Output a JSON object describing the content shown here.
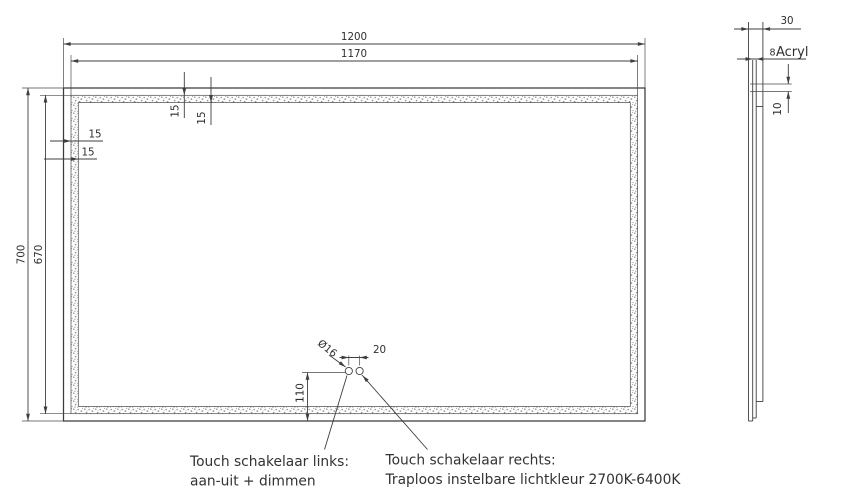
{
  "colors": {
    "line": "#3f3f3f",
    "text": "#2f2f2f",
    "background": "#ffffff"
  },
  "front_view": {
    "dim_width_outer": "1200",
    "dim_width_inner": "1170",
    "dim_height_outer": "700",
    "dim_height_inner": "670",
    "dim_border_top_offset": "15",
    "dim_border_top_width": "15",
    "dim_border_left_offset": "15",
    "dim_border_left_width": "15",
    "switch_diameter": "Ø16",
    "switch_spacing": "20",
    "switch_height": "110"
  },
  "side_view": {
    "dim_depth": "30",
    "acryl_thickness": "8",
    "acryl_label": "Acryl",
    "dim_led_offset": "10"
  },
  "annotations": {
    "switch_left_title": "Touch schakelaar links:",
    "switch_left_desc": "aan-uit + dimmen",
    "switch_right_title": "Touch schakelaar rechts:",
    "switch_right_desc": "Traploos instelbare lichtkleur 2700K-6400K"
  }
}
